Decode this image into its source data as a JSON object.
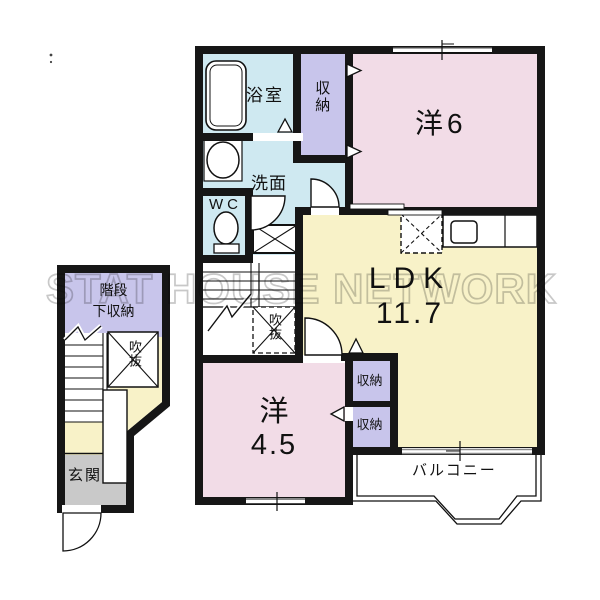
{
  "title": "apartment-floor-plan",
  "watermark": {
    "text": "STAT HOUSE NETWORK"
  },
  "palette": {
    "wall": "#161616",
    "wet_area": "#cfe9f1",
    "closet": "#c8c5eb",
    "bedroom": "#f2dce7",
    "ldk": "#f8f2c8",
    "entrance_floor": "#c9c9c9",
    "window_line": "#8a8a8a",
    "watermark_stroke": "#c8c8c8"
  },
  "floor2": {
    "bathroom": {
      "label": "浴室"
    },
    "washroom": {
      "label": "洗面"
    },
    "toilet": {
      "label": "WC"
    },
    "closet_top": {
      "label": "収納"
    },
    "bedroom_6": {
      "label": "洋6"
    },
    "ldk": {
      "label": "LDK",
      "size": "11.7"
    },
    "void": {
      "label": "吹抜"
    },
    "closet_a": {
      "label": "収納"
    },
    "closet_b": {
      "label": "収納"
    },
    "bedroom_45": {
      "label": "洋",
      "size": "4.5"
    },
    "balcony": {
      "label": "バルコニー"
    }
  },
  "floor1": {
    "under_stair_storage": {
      "label_line1": "階段",
      "label_line2": "下収納"
    },
    "void": {
      "label": "吹抜"
    },
    "entrance": {
      "label": "玄関"
    }
  }
}
